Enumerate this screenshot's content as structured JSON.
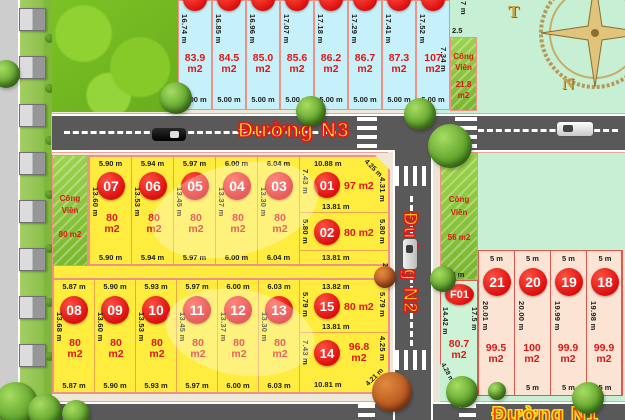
{
  "roads": {
    "n3": "Đường N3",
    "n2": "Đường N2",
    "n1": "Đường N1"
  },
  "compass": {
    "west": "T",
    "south": "N"
  },
  "top_strip": {
    "edge7": "7 m",
    "lots": [
      {
        "len": "16.74 m",
        "area": "83.9",
        "unit": "m2",
        "w": "5.00 m"
      },
      {
        "len": "16.85 m",
        "area": "84.5",
        "unit": "m2",
        "w": "5.00 m"
      },
      {
        "len": "16.96 m",
        "area": "85.0",
        "unit": "m2",
        "w": "5.00 m"
      },
      {
        "len": "17.07 m",
        "area": "85.6",
        "unit": "m2",
        "w": "5.00 m"
      },
      {
        "len": "17.18 m",
        "area": "86.2",
        "unit": "m2",
        "w": "5.00 m"
      },
      {
        "len": "17.29 m",
        "area": "86.7",
        "unit": "m2",
        "w": "5.00 m"
      },
      {
        "len": "17.41 m",
        "area": "87.3",
        "unit": "m2",
        "w": "5.00 m"
      },
      {
        "len": "17.52 m",
        "area": "107",
        "unit": "m2",
        "w": "5.00 m",
        "side": "7.34 m"
      }
    ],
    "park": {
      "name1": "Công",
      "name2": "Viên",
      "area": "21.8",
      "unit": "m2",
      "w": "2.5"
    }
  },
  "row1": {
    "alley": "2 m",
    "park": {
      "name1": "Công",
      "name2": "Viên",
      "area": "80 m2"
    },
    "lots": [
      {
        "num": "07",
        "top": "5.90 m",
        "len": "13.60 m",
        "area": "80",
        "unit": "m2",
        "bottom": "5.90 m"
      },
      {
        "num": "06",
        "top": "5.94 m",
        "len": "13.53 m",
        "area": "80",
        "unit": "m2",
        "bottom": "5.94 m"
      },
      {
        "num": "05",
        "top": "5.97 m",
        "len": "13.45 m",
        "area": "80",
        "unit": "m2",
        "bottom": "5.97 m"
      },
      {
        "num": "04",
        "top": "6.00 m",
        "len": "13.37 m",
        "area": "80",
        "unit": "m2",
        "bottom": "6.00 m"
      },
      {
        "num": "03",
        "top": "6.04 m",
        "len": "13.30 m",
        "area": "80",
        "unit": "m2",
        "bottom": "6.04 m"
      }
    ],
    "lot01": {
      "num": "01",
      "top": "10.88 m",
      "diag": "4.25 m",
      "right": "4.31 m",
      "left": "7.43 m",
      "area": "97 m2",
      "bottom": "13.81 m"
    },
    "lot02": {
      "num": "02",
      "left": "5.80 m",
      "right": "5.80 m",
      "area": "80 m2",
      "bottom": "13.81 m"
    }
  },
  "row2": {
    "lots": [
      {
        "num": "08",
        "top": "5.87 m",
        "len": "13.68 m",
        "area": "80",
        "unit": "m2",
        "bottom": "5.87 m"
      },
      {
        "num": "09",
        "top": "5.90 m",
        "len": "13.60 m",
        "area": "80",
        "unit": "m2",
        "bottom": "5.90 m"
      },
      {
        "num": "10",
        "top": "5.93 m",
        "len": "13.53 m",
        "area": "80",
        "unit": "m2",
        "bottom": "5.93 m"
      },
      {
        "num": "11",
        "top": "5.97 m",
        "len": "13.45 m",
        "area": "80",
        "unit": "m2",
        "bottom": "5.97 m"
      },
      {
        "num": "12",
        "top": "6.00 m",
        "len": "13.37 m",
        "area": "80",
        "unit": "m2",
        "bottom": "6.00 m"
      },
      {
        "num": "13",
        "top": "6.03 m",
        "len": "13.30 m",
        "area": "80",
        "unit": "m2",
        "bottom": "6.03 m"
      }
    ],
    "lot15": {
      "num": "15",
      "top": "13.82 m",
      "left": "5.79 m",
      "right": "5.79 m",
      "area": "80 m2",
      "bottom": "13.81 m"
    },
    "lot14": {
      "num": "14",
      "left": "7.43 m",
      "area": "96.8",
      "unit": "m2",
      "bottom": "10.81 m",
      "diag": "4.21 m",
      "right": "4.25 m"
    }
  },
  "east": {
    "park": {
      "name1": "Công",
      "name2": "Viên",
      "area": "56 m2"
    },
    "f01": {
      "w": "5.02 m",
      "num": "F01",
      "left": "14.42 m",
      "right": "17.5 m",
      "area": "80.7",
      "unit": "m2",
      "diag": "4.28 m",
      "b": "1.7"
    },
    "lots": [
      {
        "num": "21",
        "top": "5 m",
        "len": "20.01 m",
        "area": "99.5",
        "unit": "m2",
        "bottom": "5 m"
      },
      {
        "num": "20",
        "top": "5 m",
        "len": "20.00 m",
        "area": "100",
        "unit": "m2",
        "bottom": "5 m"
      },
      {
        "num": "19",
        "top": "5 m",
        "len": "19.99 m",
        "area": "99.9",
        "unit": "m2",
        "bottom": "5 m"
      },
      {
        "num": "18",
        "top": "5 m",
        "len": "19.98 m",
        "area": "99.9",
        "unit": "m2",
        "bottom": "5 m"
      }
    ]
  },
  "colors": {
    "accent_red": "#e01616",
    "lot_yellow": "#ffec3f",
    "lot_cyan": "#c6f1fa",
    "lot_pink": "#fbe4d3",
    "park_green": "#8cc63f",
    "road_gray": "#595959",
    "mint": "#c7efd3"
  }
}
